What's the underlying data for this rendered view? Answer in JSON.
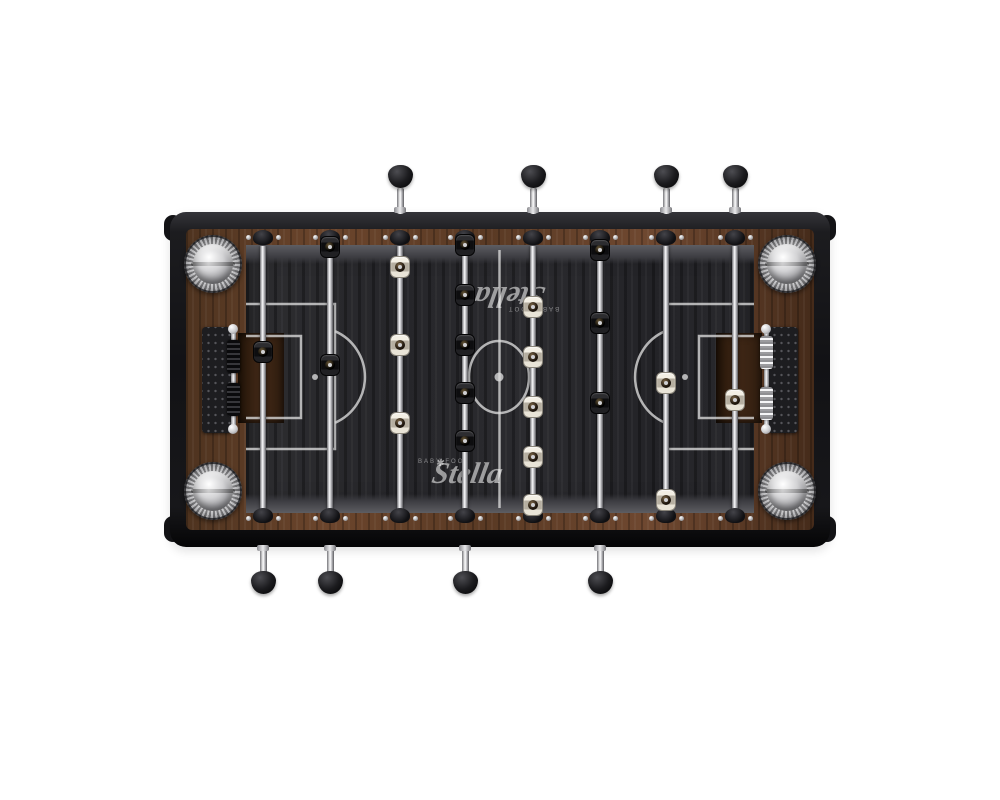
{
  "product": {
    "description": "Top-down view of a Stella baby-foot (foosball) table",
    "brand": {
      "script": "Stella",
      "sub": "BABY-FOOT",
      "star": "✱"
    }
  },
  "colors": {
    "rim_black": "#141417",
    "wood_walnut": "#5e3c26",
    "pitch_charcoal": "#29292d",
    "marking_white": "#dcdcdc",
    "chrome": "#f4f4f6",
    "goal_brown": "#3f2716",
    "team_black": "#0d0d0f",
    "team_white": "#e9e4d7"
  },
  "rods": [
    {
      "id": "black-goalie",
      "team": "black",
      "handle": "bottom",
      "x": 263,
      "players_y": [
        352
      ]
    },
    {
      "id": "black-defense",
      "team": "black",
      "handle": "bottom",
      "x": 330,
      "players_y": [
        247,
        365
      ]
    },
    {
      "id": "white-attack",
      "team": "white",
      "handle": "top",
      "x": 400,
      "players_y": [
        267,
        345,
        423
      ]
    },
    {
      "id": "black-midfield",
      "team": "black",
      "handle": "bottom",
      "x": 465,
      "players_y": [
        245,
        295,
        345,
        393,
        441
      ]
    },
    {
      "id": "white-midfield",
      "team": "white",
      "handle": "top",
      "x": 533,
      "players_y": [
        307,
        357,
        407,
        457,
        505
      ]
    },
    {
      "id": "black-attack",
      "team": "black",
      "handle": "bottom",
      "x": 600,
      "players_y": [
        250,
        323,
        403
      ]
    },
    {
      "id": "white-defense",
      "team": "white",
      "handle": "top",
      "x": 666,
      "players_y": [
        383,
        500
      ]
    },
    {
      "id": "white-goalie",
      "team": "white",
      "handle": "top",
      "x": 735,
      "players_y": [
        400
      ]
    }
  ],
  "counters": [
    {
      "side": "left",
      "bead_style": "black",
      "bead_groups_y": [
        [
          340,
          33
        ],
        [
          383,
          33
        ]
      ]
    },
    {
      "side": "right",
      "bead_style": "chrome",
      "bead_groups_y": [
        [
          336,
          33
        ],
        [
          387,
          33
        ]
      ]
    }
  ],
  "ashtrays": [
    {
      "x": 213,
      "y": 264
    },
    {
      "x": 213,
      "y": 491
    },
    {
      "x": 787,
      "y": 264
    },
    {
      "x": 787,
      "y": 491
    }
  ],
  "logos": [
    {
      "x": 542,
      "y": 289,
      "rotation": 180
    },
    {
      "x": 435,
      "y": 481,
      "rotation": 0
    }
  ]
}
